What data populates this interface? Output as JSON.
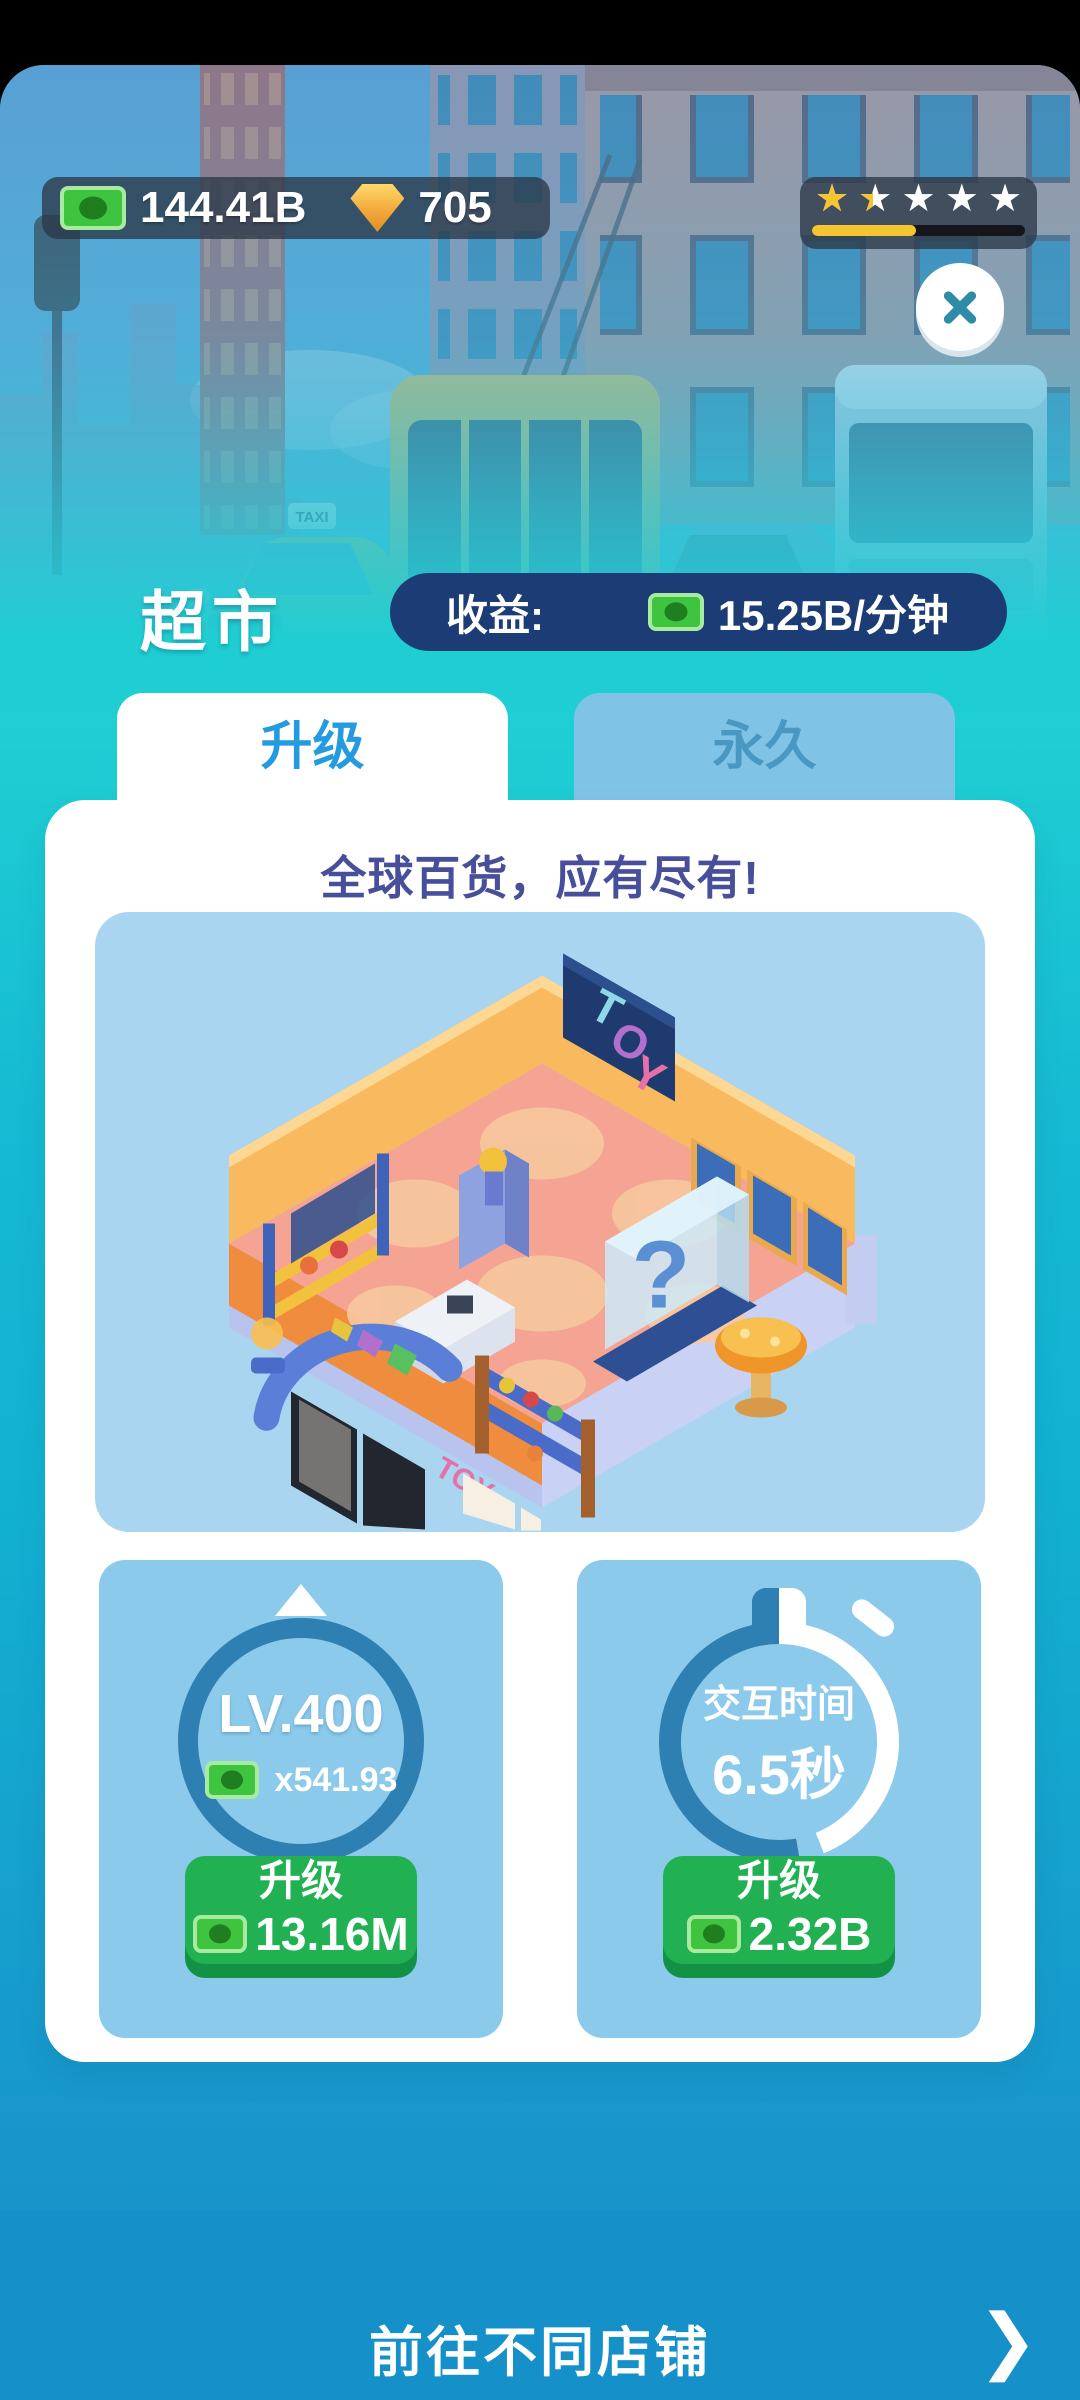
{
  "header": {
    "money": "144.41B",
    "diamonds": "705",
    "rating": {
      "star_char": "★",
      "stars": [
        100,
        45,
        0,
        0,
        0
      ],
      "progress_percent": 49
    }
  },
  "shop": {
    "title": "超市",
    "income_label": "收益:",
    "income_value": "15.25B/分钟"
  },
  "tabs": {
    "upgrade": "升级",
    "permanent": "永久"
  },
  "card": {
    "headline": "全球百货，应有尽有!",
    "store": {
      "sign_letters": [
        "T",
        "O",
        "Y"
      ],
      "front_sign": "TOY",
      "mystery_mark": "?"
    },
    "level_upgrade": {
      "level": "LV.400",
      "multiplier": "x541.93",
      "button_label": "升级",
      "cost": "13.16M"
    },
    "interaction_upgrade": {
      "label": "交互时间",
      "value": "6.5秒",
      "button_label": "升级",
      "cost": "2.32B"
    }
  },
  "scene": {
    "taxi_sign": "TAXI"
  },
  "footer": {
    "label": "前往不同店铺",
    "chevron": "❯"
  },
  "colors": {
    "money_green": "#3ec43e",
    "diamond_orange": "#f2a93b",
    "star_yellow": "#f4c431",
    "pill_navy": "#1b3c74",
    "tab_active_text": "#259bdf",
    "headline_indigo": "#474f9b",
    "panel_blue": "#8ccaeb",
    "ring_blue": "#2e80b2",
    "button_green": "#21b152",
    "footer_blue": "#1590c8",
    "close_teal": "#2f8ca8"
  }
}
